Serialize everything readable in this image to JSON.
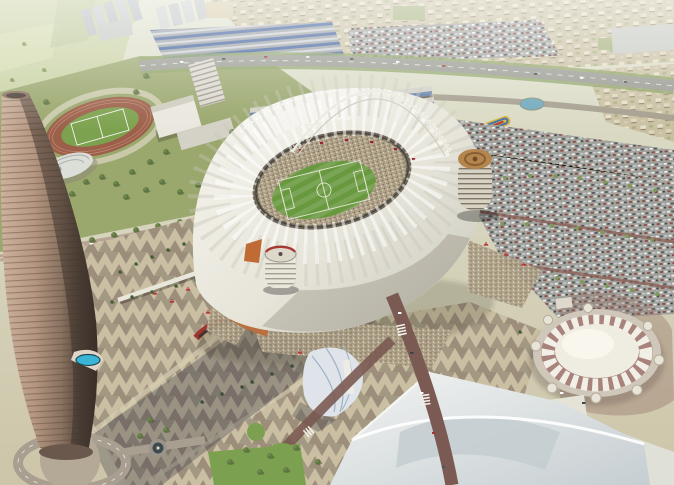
{
  "scene": {
    "description": "Aerial architectural rendering of the Khalifa International Stadium sports precinct in Doha, Qatar",
    "landmarks": [
      {
        "id": "stadium",
        "label": "Khalifa International Stadium: white membrane roof, open bowl with crowd and green football pitch"
      },
      {
        "id": "aspire-tower",
        "label": "Aspire Tower (The Torch Doha): tapered bronze cylindrical skyscraper with cantilevered sky pool"
      },
      {
        "id": "aspire-dome",
        "label": "White sports dome with sawtooth skirt band and round corner turrets"
      },
      {
        "id": "aquatic-centre",
        "label": "Aquatic centre with white swooping roof"
      },
      {
        "id": "athletics-track",
        "label": "Outdoor athletics track with terracotta lanes and green infield"
      },
      {
        "id": "plaza",
        "label": "Triangle-patterned celebration plaza with palm trees, red tents and the tower's long shadow"
      },
      {
        "id": "parking",
        "label": "Surface car parks filled with cars and rows of trees"
      },
      {
        "id": "housing",
        "label": "Low-rise beige housing districts beyond the ring road"
      },
      {
        "id": "arch",
        "label": "White lattice arch sweeping over the stadium roof"
      },
      {
        "id": "sail-pavilion",
        "label": "Small white sail-membrane pavilion"
      },
      {
        "id": "sky-pool",
        "label": "Blue cantilevered pool ledge on the tower"
      },
      {
        "id": "campus",
        "label": "Academy campus: white buildings, terraced blue-glass rows and lawns"
      }
    ]
  },
  "palette": {
    "plaza_base": "#cabfa3",
    "pitch_green": "#69993f",
    "infield_green": "#7da24f",
    "track_terracotta": "#9c604a",
    "campus_green": "#9aa76d",
    "lawn_green": "#7ba04f",
    "dome_white": "#efece2",
    "stadium_roof": "#eceadf",
    "parking_grey": "#9c9c96",
    "road_maroon": "#7a5a52",
    "tower_bronze": "#a88b77",
    "water_blue": "#3ab5d6",
    "crowd_beige": "#b3a68c",
    "aqua_roof": "#e4e7e6",
    "tree_green": "#5d7540",
    "flag_red": "#9b2335"
  }
}
